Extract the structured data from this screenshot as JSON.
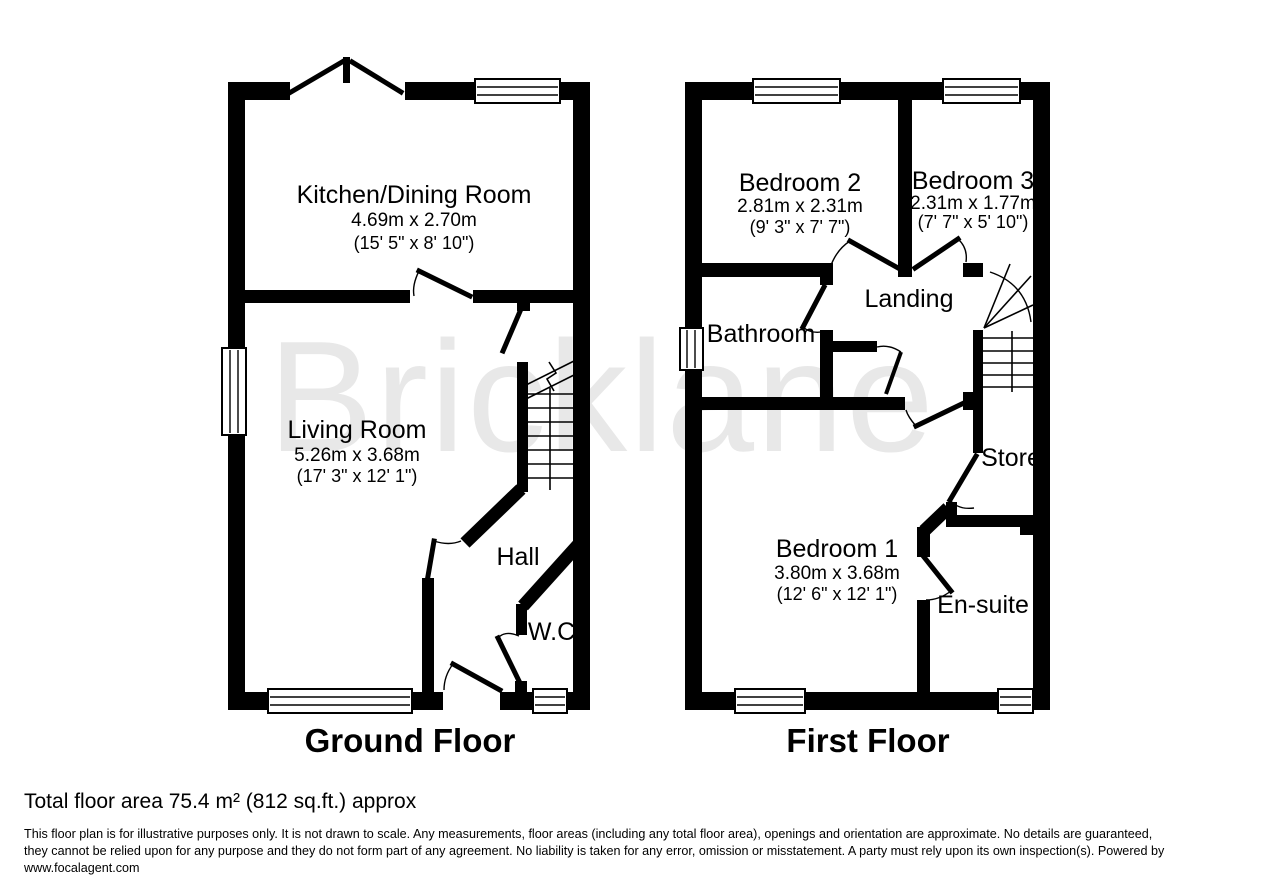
{
  "watermark": "Bricklane",
  "ground_floor": {
    "title": "Ground Floor",
    "rooms": {
      "kitchen": {
        "name": "Kitchen/Dining Room",
        "metric": "4.69m x 2.70m",
        "imperial": "(15' 5\" x 8' 10\")"
      },
      "living": {
        "name": "Living Room",
        "metric": "5.26m x 3.68m",
        "imperial": "(17' 3\" x 12' 1\")"
      },
      "hall": {
        "name": "Hall"
      },
      "wc": {
        "name": "W.C."
      }
    }
  },
  "first_floor": {
    "title": "First Floor",
    "rooms": {
      "bedroom2": {
        "name": "Bedroom 2",
        "metric": "2.81m x 2.31m",
        "imperial": "(9' 3\" x 7' 7\")"
      },
      "bedroom3": {
        "name": "Bedroom 3",
        "metric": "2.31m x 1.77m",
        "imperial": "(7' 7\" x 5' 10\")"
      },
      "landing": {
        "name": "Landing"
      },
      "bathroom": {
        "name": "Bathroom"
      },
      "store": {
        "name": "Store"
      },
      "bedroom1": {
        "name": "Bedroom 1",
        "metric": "3.80m x 3.68m",
        "imperial": "(12' 6\" x 12' 1\")"
      },
      "ensuite": {
        "name": "En-suite"
      }
    }
  },
  "footer": {
    "total_area": "Total floor area 75.4 m² (812 sq.ft.) approx",
    "disclaimer_line1": "This floor plan is for illustrative purposes only. It is not drawn to scale. Any measurements, floor areas (including any total floor area), openings and orientation are approximate. No details are guaranteed,",
    "disclaimer_line2": "they cannot be relied upon for any purpose and they do not form part of any agreement. No liability is taken for any error, omission or misstatement. A party must rely upon its own inspection(s). Powered by",
    "website": "www.focalagent.com"
  },
  "colors": {
    "wall": "#000000",
    "watermark": "#e8e8e8",
    "background": "#ffffff",
    "text": "#000000"
  }
}
